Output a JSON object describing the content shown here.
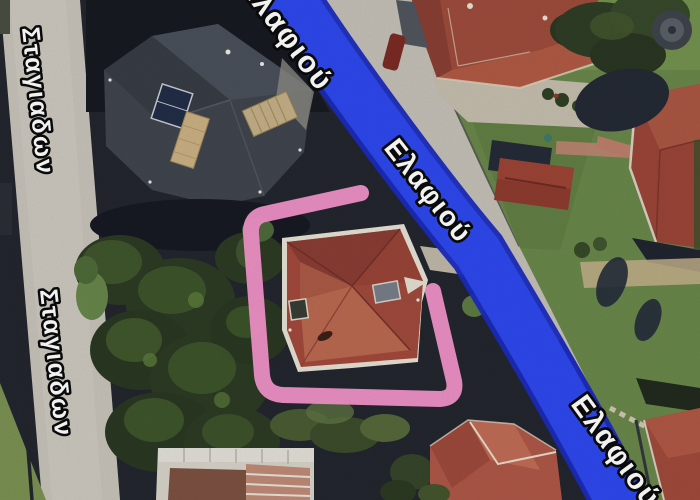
{
  "map": {
    "street_labels": {
      "stagiadon_upper": "Σταγιαδων",
      "stagiadon_lower": "Σταγιαδων",
      "elafiou_top": "Ελαφιού",
      "elafiou_main": "Ελαφιού",
      "elafiou_bottom": "Ελαφιού"
    },
    "route_highlight": {
      "color": "#2e49f0",
      "edge_color": "#1c2cbe"
    },
    "annotation": {
      "shape": "hand-drawn-rectangle",
      "color": "#f293c9"
    }
  }
}
